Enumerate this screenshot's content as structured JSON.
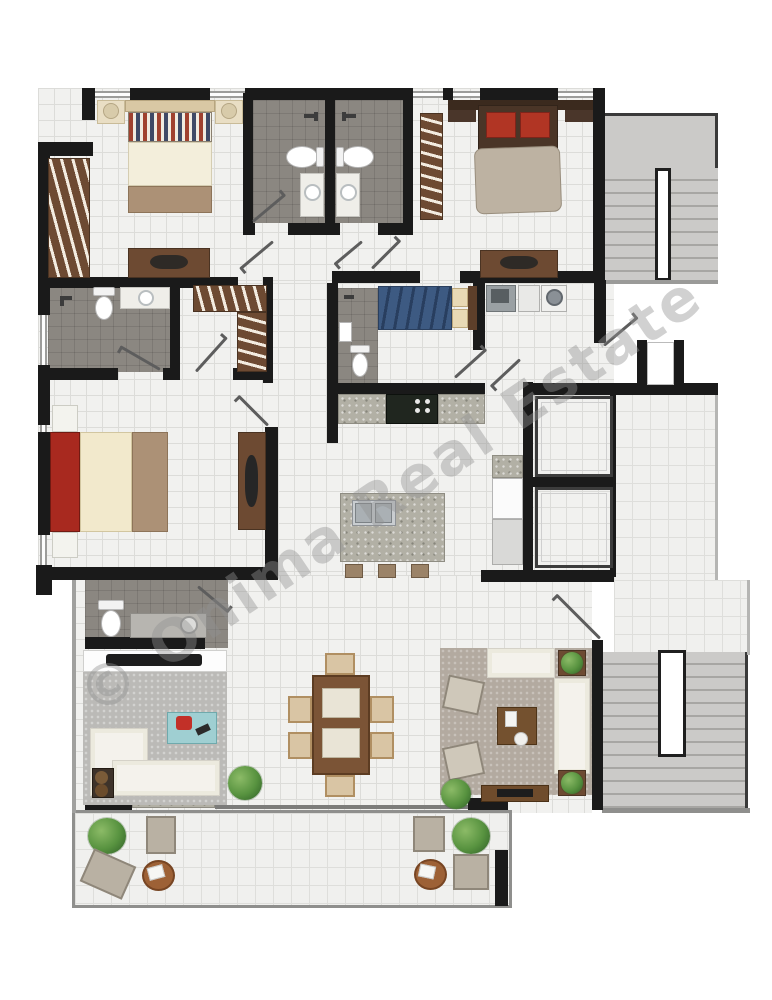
{
  "watermark": {
    "text": "© Onima Real Estate",
    "color": "rgba(146,146,146,0.42)"
  },
  "palette": {
    "wall": "#1a1a1a",
    "floor": "#f1f1ef",
    "floorline": "#dcdcd9",
    "bath": "#8b8781",
    "wood": "#6d4a32",
    "wood2": "#7b5436",
    "granite": "#b2b0a5",
    "stairs": "#cbcac8",
    "elevator": "#7b7b7b",
    "rug1": "#bbbab7",
    "rug2": "#b3aaa0",
    "sofa": "#f4f2ec",
    "cream": "#f2e9cc",
    "tan": "#ac9176",
    "red_bed": "#a8291f",
    "blue_bed": "#3d5a82",
    "teal_table": "#9fcfd2",
    "chair": "#d9c5a4"
  }
}
